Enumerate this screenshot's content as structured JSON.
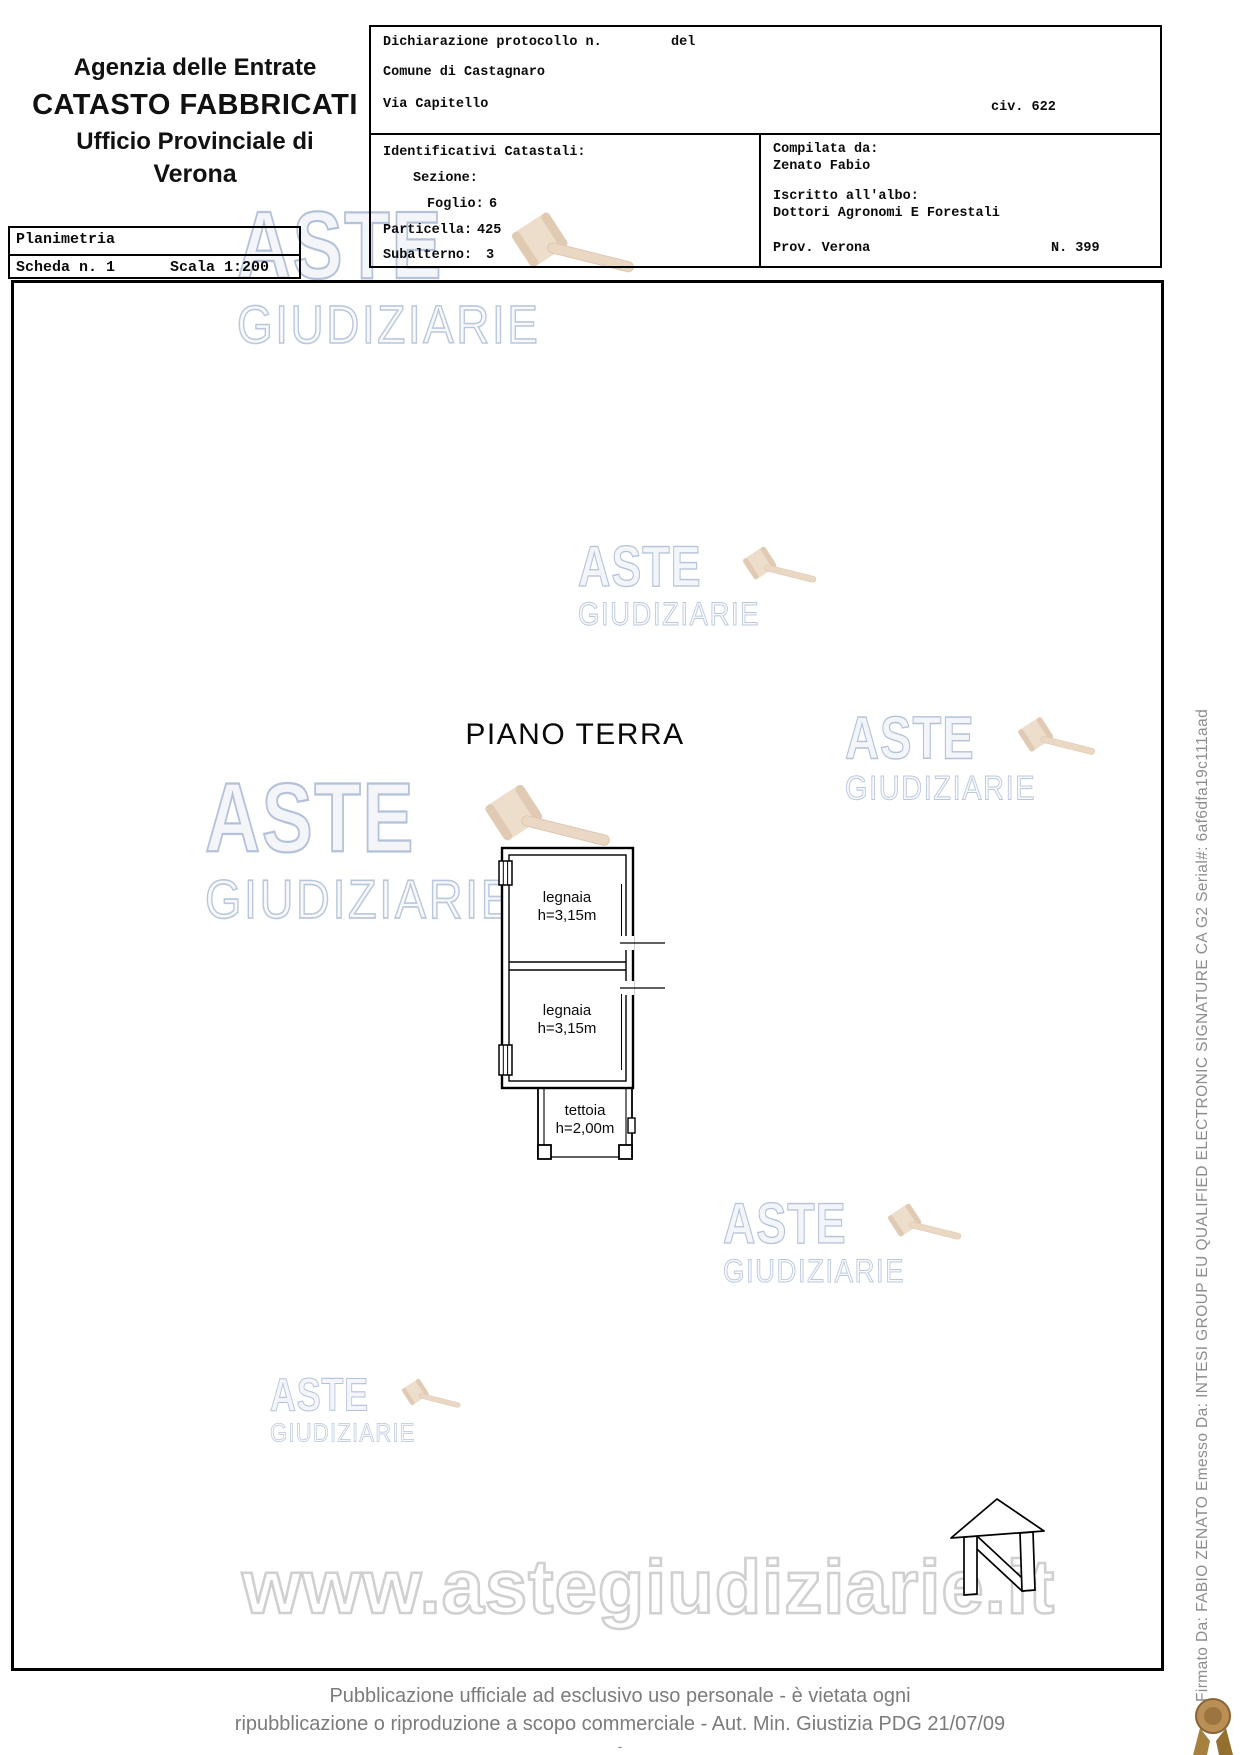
{
  "header": {
    "agency_line1": "Agenzia delle Entrate",
    "agency_line2": "CATASTO FABBRICATI",
    "agency_line3": "Ufficio Provinciale di",
    "agency_line4": "Verona",
    "planimetria": {
      "title": "Planimetria",
      "scheda": "Scheda n. 1",
      "scala": "Scala 1:200"
    },
    "declaration": {
      "protocollo_label": "Dichiarazione protocollo n.",
      "del_label": "del",
      "comune": "Comune di Castagnaro",
      "via": "Via Capitello",
      "civ": "civ. 622"
    },
    "catasto": {
      "title": "Identificativi Catastali:",
      "sezione_label": "Sezione:",
      "foglio_label": "Foglio:",
      "foglio_value": "6",
      "particella_label": "Particella:",
      "particella_value": "425",
      "subalterno_label": "Subalterno:",
      "subalterno_value": "3"
    },
    "compiler": {
      "compilata_label": "Compilata da:",
      "compilata_value": "Zenato Fabio",
      "albo_label": "Iscritto all'albo:",
      "albo_value": "Dottori Agronomi E Forestali",
      "prov": "Prov. Verona",
      "numero": "N. 399"
    }
  },
  "plan": {
    "floor_title": "PIANO TERRA",
    "rooms": [
      {
        "name": "legnaia",
        "height": "h=3,15m"
      },
      {
        "name": "legnaia",
        "height": "h=3,15m"
      },
      {
        "name": "tettoia",
        "height": "h=2,00m"
      }
    ]
  },
  "watermarks": {
    "aste": "ASTE",
    "giudiziarie": "GIUDIZIARIE",
    "url": "www.astegiudiziarie.it",
    "blue": "#9aacce",
    "tan": "#e2cdb4"
  },
  "footer": {
    "line1": "Pubblicazione ufficiale ad esclusivo uso personale - è vietata ogni",
    "line2": "ripubblicazione o riproduzione a scopo commerciale - Aut. Min. Giustizia PDG 21/07/09",
    "dash": "-"
  },
  "signature_sidebar": "Firmato Da: FABIO ZENATO Emesso Da: INTESI GROUP EU QUALIFIED ELECTRONIC SIGNATURE CA G2 Serial#: 6af6dfa19c111aad"
}
